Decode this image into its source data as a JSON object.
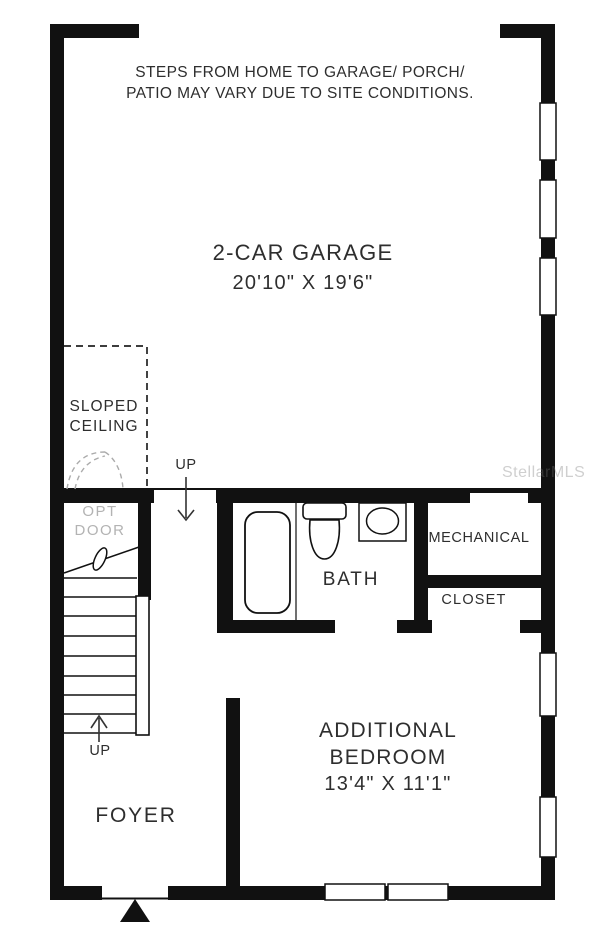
{
  "plan": {
    "disclaimer": {
      "line1": "STEPS FROM HOME TO GARAGE/ PORCH/",
      "line2": "PATIO MAY VARY DUE TO SITE CONDITIONS."
    },
    "watermark": "StellarMLS",
    "rooms": {
      "garage": {
        "name": "2-CAR GARAGE",
        "dims": "20'10\" X 19'6\""
      },
      "bath": {
        "name": "BATH"
      },
      "mechanical": {
        "name": "MECHANICAL"
      },
      "closet": {
        "name": "CLOSET"
      },
      "bedroom": {
        "line1": "ADDITIONAL",
        "line2": "BEDROOM",
        "dims": "13'4\" X 11'1\""
      },
      "foyer": {
        "name": "FOYER"
      }
    },
    "annotations": {
      "sloped_ceiling": {
        "line1": "SLOPED",
        "line2": "CEILING"
      },
      "opt_door": {
        "line1": "OPT",
        "line2": "DOOR"
      },
      "up_top": "UP",
      "up_bottom": "UP"
    },
    "colors": {
      "wall": "#111111",
      "text": "#2e2e2e",
      "muted_text": "#b3b3b3",
      "dashed_gray": "#ababab",
      "background": "#ffffff"
    }
  }
}
